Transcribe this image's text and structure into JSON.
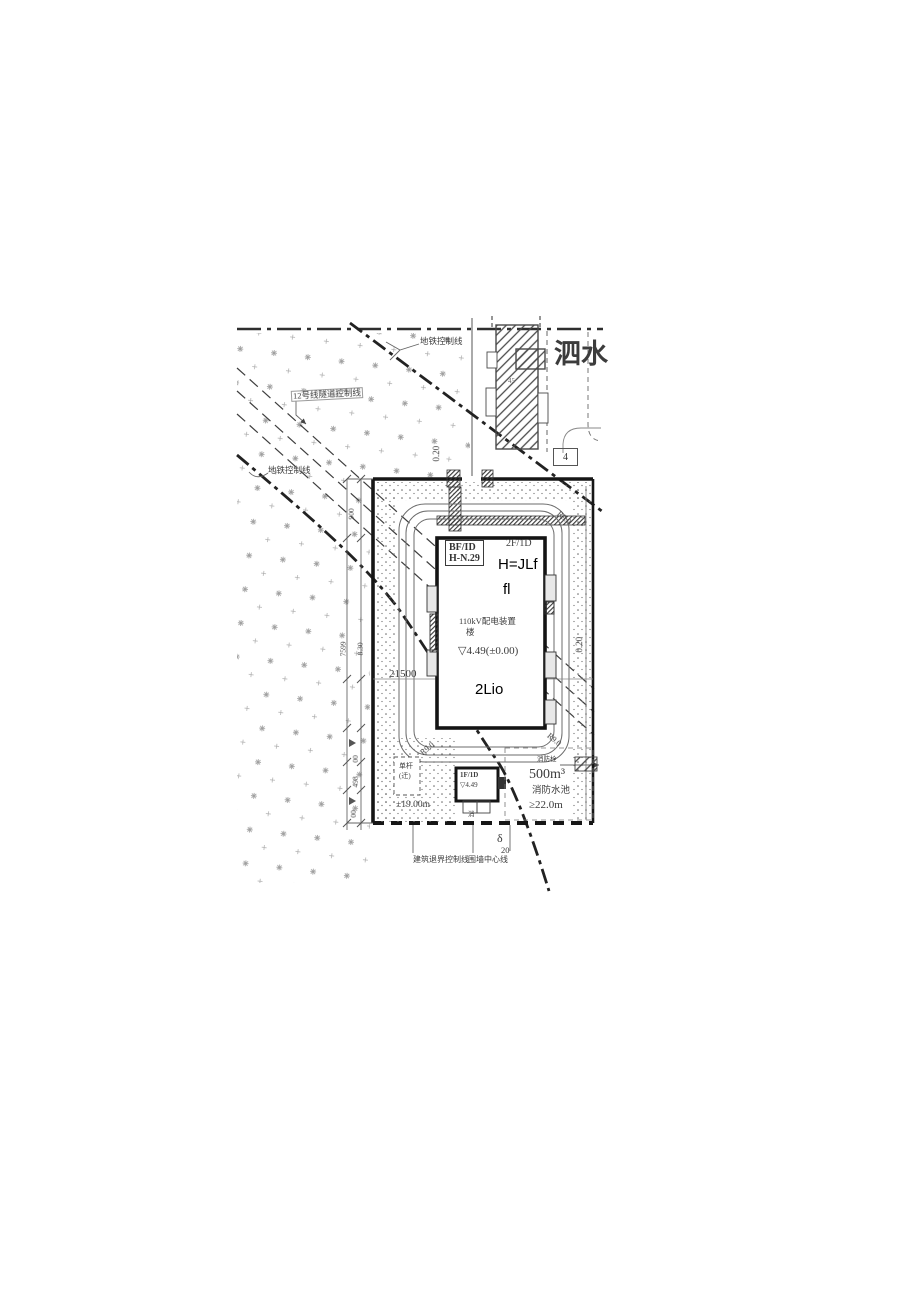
{
  "drawing": {
    "street_label": "泗水",
    "annotations": {
      "metro_control_top": "地铁控制线",
      "tunnel_control": "12号线隧道控制线",
      "metro_control_left": "地铁控制线",
      "curb_offset_top": "0.20",
      "curb_offset_right": "0.20",
      "parcel_number": "4",
      "existing_mark": "45",
      "road_radius_1": "R9.0",
      "road_radius_2": "R9.0",
      "road_radius_3": "R9.0",
      "boundary_label_left": "建筑退界控制线",
      "boundary_label_right": "围墙中心线",
      "delta_symbol": "δ",
      "delta_value": "20"
    },
    "building": {
      "basement_tag_line1": "BF/ID",
      "basement_tag_line2": "H-N.29",
      "floors_tag": "2F/1D",
      "name_line1": "110kV配电装置",
      "name_line2": "楼",
      "elevation": "▽4.49(±0.00)",
      "overlay_text_1": "H=JLf",
      "overlay_text_2": "fl",
      "overlay_text_3": "2Lio"
    },
    "pump_house": {
      "tag": "1F/1D",
      "elevation": "▽4.49",
      "mark": "消"
    },
    "pole": {
      "line1": "单杆",
      "line2": "(迁)"
    },
    "fire_pool": {
      "volume": "500m³",
      "name": "消防水池",
      "distance": "≥22.0m",
      "hydrant": "消防栓"
    },
    "dimensions": {
      "site_width": "21500",
      "d_900": "900",
      "d_7599": "7599",
      "d_830": "8.30",
      "d_00a": "00",
      "d_498": "498",
      "d_00b": "00",
      "clearance": "±19.00m"
    }
  }
}
